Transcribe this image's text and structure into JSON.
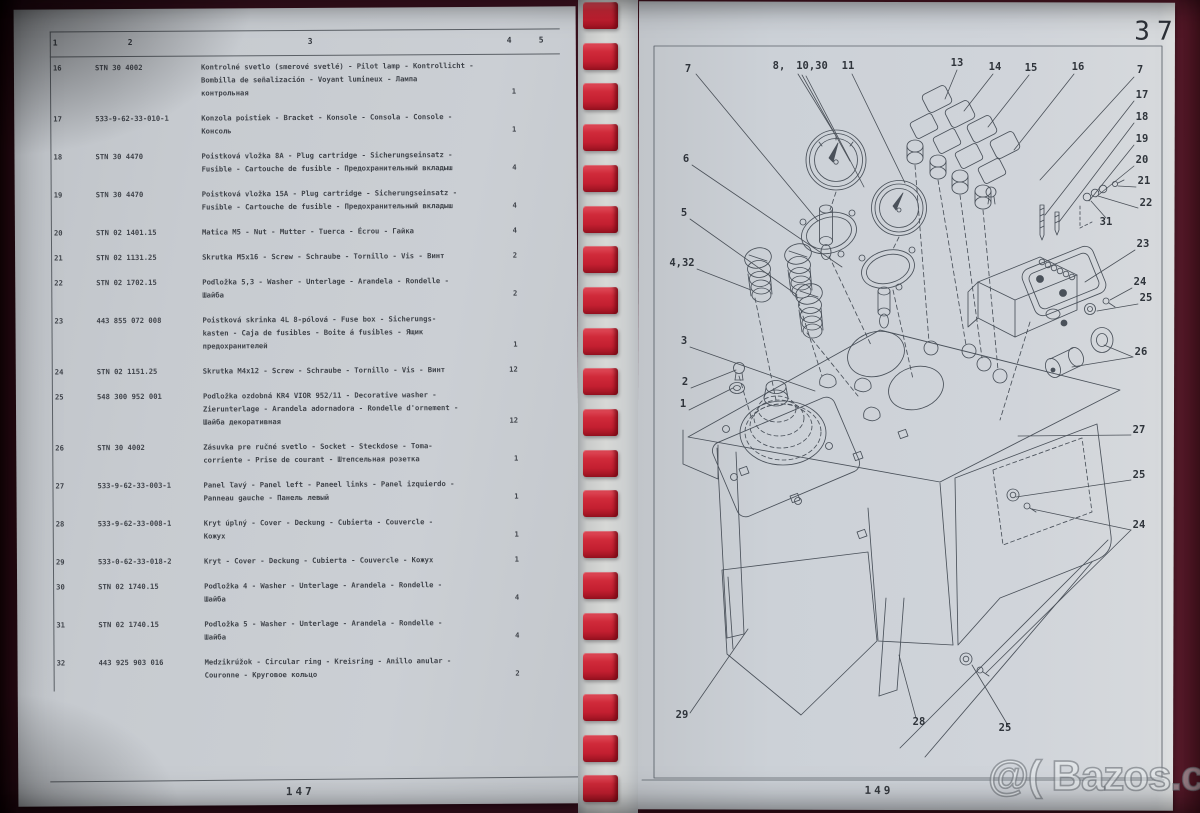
{
  "book": {
    "left_page": {
      "page_number": "147",
      "table": {
        "headers": [
          "1",
          "2",
          "3",
          "4",
          "5"
        ],
        "rows": [
          {
            "no": "16",
            "part": "STN 30 4002",
            "desc": [
              "Kontrolné svetlo (smerové svetlé) - Pilot lamp - Kontrollicht -",
              "Bombilla de señalización - Voyant lumineux - Лампа",
              "контрольная"
            ],
            "qty": "1"
          },
          {
            "no": "17",
            "part": "533-9-62-33-010-1",
            "desc": [
              "Konzola poistiek - Bracket - Konsole - Consola - Console -",
              "Консоль"
            ],
            "qty": "1"
          },
          {
            "no": "18",
            "part": "STN 30 4470",
            "desc": [
              "Poistková vložka 8A - Plug cartridge - Sicherungseinsatz -",
              "Fusible - Cartouche de fusible - Предохранительный вкладыш"
            ],
            "qty": "4"
          },
          {
            "no": "19",
            "part": "STN 30 4470",
            "desc": [
              "Poistková vložka 15A - Plug cartridge - Sicherungseinsatz -",
              "Fusible - Cartouche de fusible - Предохранительный вкладыш"
            ],
            "qty": "4"
          },
          {
            "no": "20",
            "part": "STN 02 1401.15",
            "desc": [
              "Matica M5 - Nut - Mutter - Tuerca - Écrou - Гайка"
            ],
            "qty": "4"
          },
          {
            "no": "21",
            "part": "STN 02 1131.25",
            "desc": [
              "Skrutka M5x16 - Screw - Schraube - Tornillo - Vis - Винт"
            ],
            "qty": "2"
          },
          {
            "no": "22",
            "part": "STN 02 1702.15",
            "desc": [
              "Podložka 5,3 - Washer - Unterlage - Arandela - Rondelle -",
              "Шайба"
            ],
            "qty": "2"
          },
          {
            "no": "23",
            "part": "443 855 072 008",
            "desc": [
              "Poistková skrinka 4L 8-pólová - Fuse box - Sicherungs-",
              "kasten - Caja de fusibles - Boite á fusibles - Ящик",
              "предохранителей"
            ],
            "qty": "1"
          },
          {
            "no": "24",
            "part": "STN 02 1151.25",
            "desc": [
              "Skrutka M4x12 - Screw - Schraube - Tornillo - Vis - Винт"
            ],
            "qty": "12"
          },
          {
            "no": "25",
            "part": "548 300 952 001",
            "desc": [
              "Podložka ozdobná KR4 VIOR 952/11 - Decorative washer -",
              "Zierunterlage - Arandela adornadora - Rondelle d'ornement -",
              "Шайба декоративная"
            ],
            "qty": "12"
          },
          {
            "no": "26",
            "part": "STN 30 4002",
            "desc": [
              "Zásuvka pre ručné svetlo - Socket - Steckdose - Toma-",
              "corriente - Prise de courant - Штепсельная розетка"
            ],
            "qty": "1"
          },
          {
            "no": "27",
            "part": "533-9-62-33-003-1",
            "desc": [
              "Panel ľavý - Panel left - Paneel links - Panel izquierdo -",
              "Panneau gauche - Панель левый"
            ],
            "qty": "1"
          },
          {
            "no": "28",
            "part": "533-9-62-33-008-1",
            "desc": [
              "Kryt úplný - Cover - Deckung - Cubierta - Couvercle -",
              "Кожух"
            ],
            "qty": "1"
          },
          {
            "no": "29",
            "part": "533-0-62-33-018-2",
            "desc": [
              "Kryt - Cover - Deckung - Cubierta - Couvercle - Кожух"
            ],
            "qty": "1"
          },
          {
            "no": "30",
            "part": "STN 02 1740.15",
            "desc": [
              "Podložka 4 - Washer - Unterlage - Arandela - Rondelle -",
              "Шайба"
            ],
            "qty": "4"
          },
          {
            "no": "31",
            "part": "STN 02 1740.15",
            "desc": [
              "Podložka 5 - Washer - Unterlage - Arandela - Rondelle -",
              "Шайба"
            ],
            "qty": "4"
          },
          {
            "no": "32",
            "part": "443 925 903 016",
            "desc": [
              "Medzikrúžok - Circular ring - Kreisring - Anillo anular -",
              "Couronne - Круговое кольцо"
            ],
            "qty": "2"
          }
        ]
      }
    },
    "right_page": {
      "chapter_number": "37",
      "page_number": "149",
      "figure_callouts": [
        {
          "label": "7",
          "x": 688,
          "y": 72
        },
        {
          "label": "8,",
          "x": 779,
          "y": 69
        },
        {
          "label": "10,30",
          "x": 812,
          "y": 69
        },
        {
          "label": "11",
          "x": 848,
          "y": 69
        },
        {
          "label": "13",
          "x": 957,
          "y": 66
        },
        {
          "label": "14",
          "x": 995,
          "y": 70
        },
        {
          "label": "15",
          "x": 1031,
          "y": 71
        },
        {
          "label": "16",
          "x": 1078,
          "y": 70
        },
        {
          "label": "7",
          "x": 1140,
          "y": 73
        },
        {
          "label": "17",
          "x": 1142,
          "y": 98
        },
        {
          "label": "18",
          "x": 1142,
          "y": 120
        },
        {
          "label": "19",
          "x": 1142,
          "y": 142
        },
        {
          "label": "20",
          "x": 1142,
          "y": 163
        },
        {
          "label": "21",
          "x": 1144,
          "y": 184
        },
        {
          "label": "22",
          "x": 1146,
          "y": 206
        },
        {
          "label": "31",
          "x": 1106,
          "y": 225
        },
        {
          "label": "23",
          "x": 1143,
          "y": 247
        },
        {
          "label": "24",
          "x": 1140,
          "y": 285
        },
        {
          "label": "25",
          "x": 1146,
          "y": 301
        },
        {
          "label": "26",
          "x": 1141,
          "y": 355
        },
        {
          "label": "6",
          "x": 686,
          "y": 162
        },
        {
          "label": "5",
          "x": 684,
          "y": 216
        },
        {
          "label": "4,32",
          "x": 682,
          "y": 266
        },
        {
          "label": "3",
          "x": 684,
          "y": 344
        },
        {
          "label": "2",
          "x": 685,
          "y": 385
        },
        {
          "label": "1",
          "x": 683,
          "y": 407
        },
        {
          "label": "27",
          "x": 1139,
          "y": 433
        },
        {
          "label": "25",
          "x": 1139,
          "y": 478
        },
        {
          "label": "24",
          "x": 1139,
          "y": 528
        },
        {
          "label": "29",
          "x": 682,
          "y": 718
        },
        {
          "label": "28",
          "x": 919,
          "y": 725
        },
        {
          "label": "25",
          "x": 1005,
          "y": 731
        }
      ]
    }
  },
  "watermark": {
    "text": "@( Bazos.cz"
  },
  "colors": {
    "binding_red": "#cc2534",
    "cover_maroon": "#4a1624",
    "paper": "#cbd0d5",
    "ink": "#34383f"
  },
  "binding": {
    "tooth_count": 20
  }
}
